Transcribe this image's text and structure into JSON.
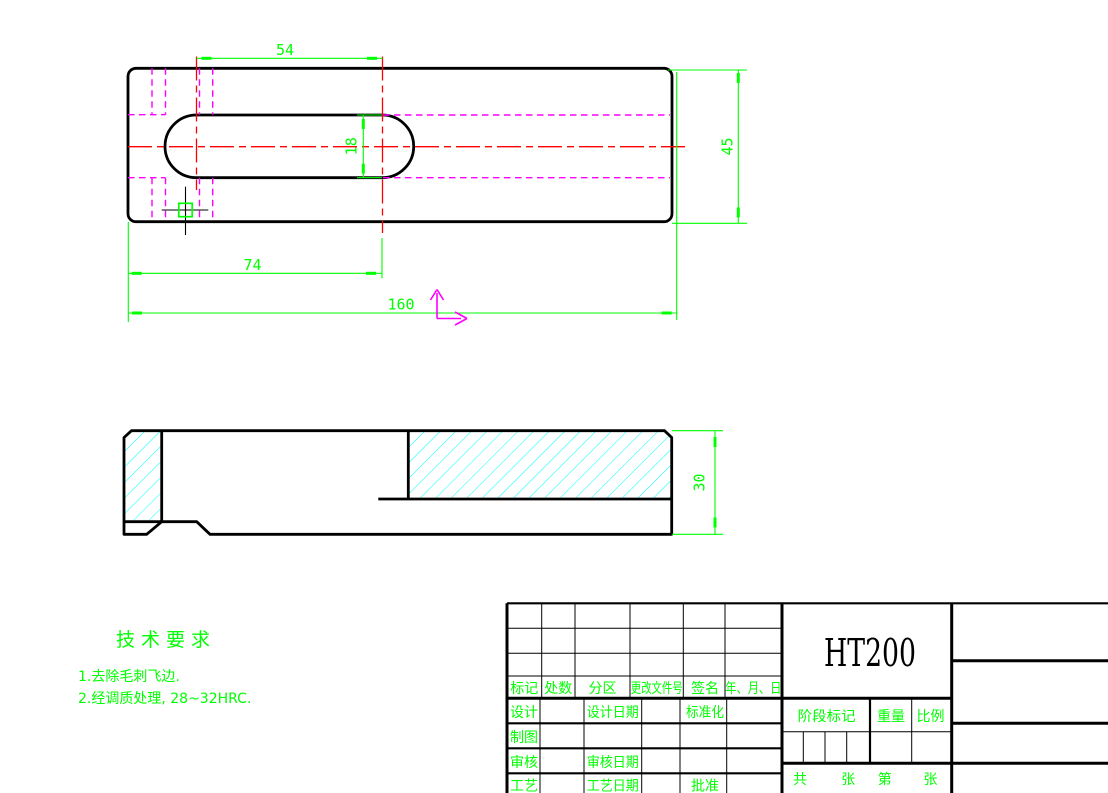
{
  "colors": {
    "background": "#ffffff",
    "outline": "#000000",
    "dimension_green": "#00ff00",
    "centerline_red": "#ff0000",
    "hidden_magenta": "#ff00ff",
    "hatch_cyan": "#00ffff"
  },
  "dimensions": {
    "slot_top_54": "54",
    "hole_pos_74": "74",
    "length_160": "160",
    "width_45": "45",
    "slot_width_18": "18",
    "thickness_30": "30"
  },
  "tech": {
    "title": "技术要求",
    "item1": "1.去除毛刺飞边.",
    "item2": "2.经调质处理, 28~32HRC."
  },
  "title_block": {
    "material": "HT200",
    "rev_headers": {
      "mark": "标记",
      "count": "处数",
      "zone": "分区",
      "change_doc_no": "更改文件号",
      "signature": "签名",
      "date": "年、月、日"
    },
    "left": {
      "design": "设计",
      "design_date": "设计日期",
      "standardize": "标准化",
      "draft": "制图",
      "check": "审核",
      "check_date": "审核日期",
      "process": "工艺",
      "process_date": "工艺日期",
      "approve": "批准"
    },
    "middle": {
      "stage_mark": "阶段标记",
      "weight": "重量",
      "scale": "比例",
      "total_label": "共",
      "sheet_label": "张",
      "no_label": "第",
      "sheet_label2": "张"
    }
  }
}
